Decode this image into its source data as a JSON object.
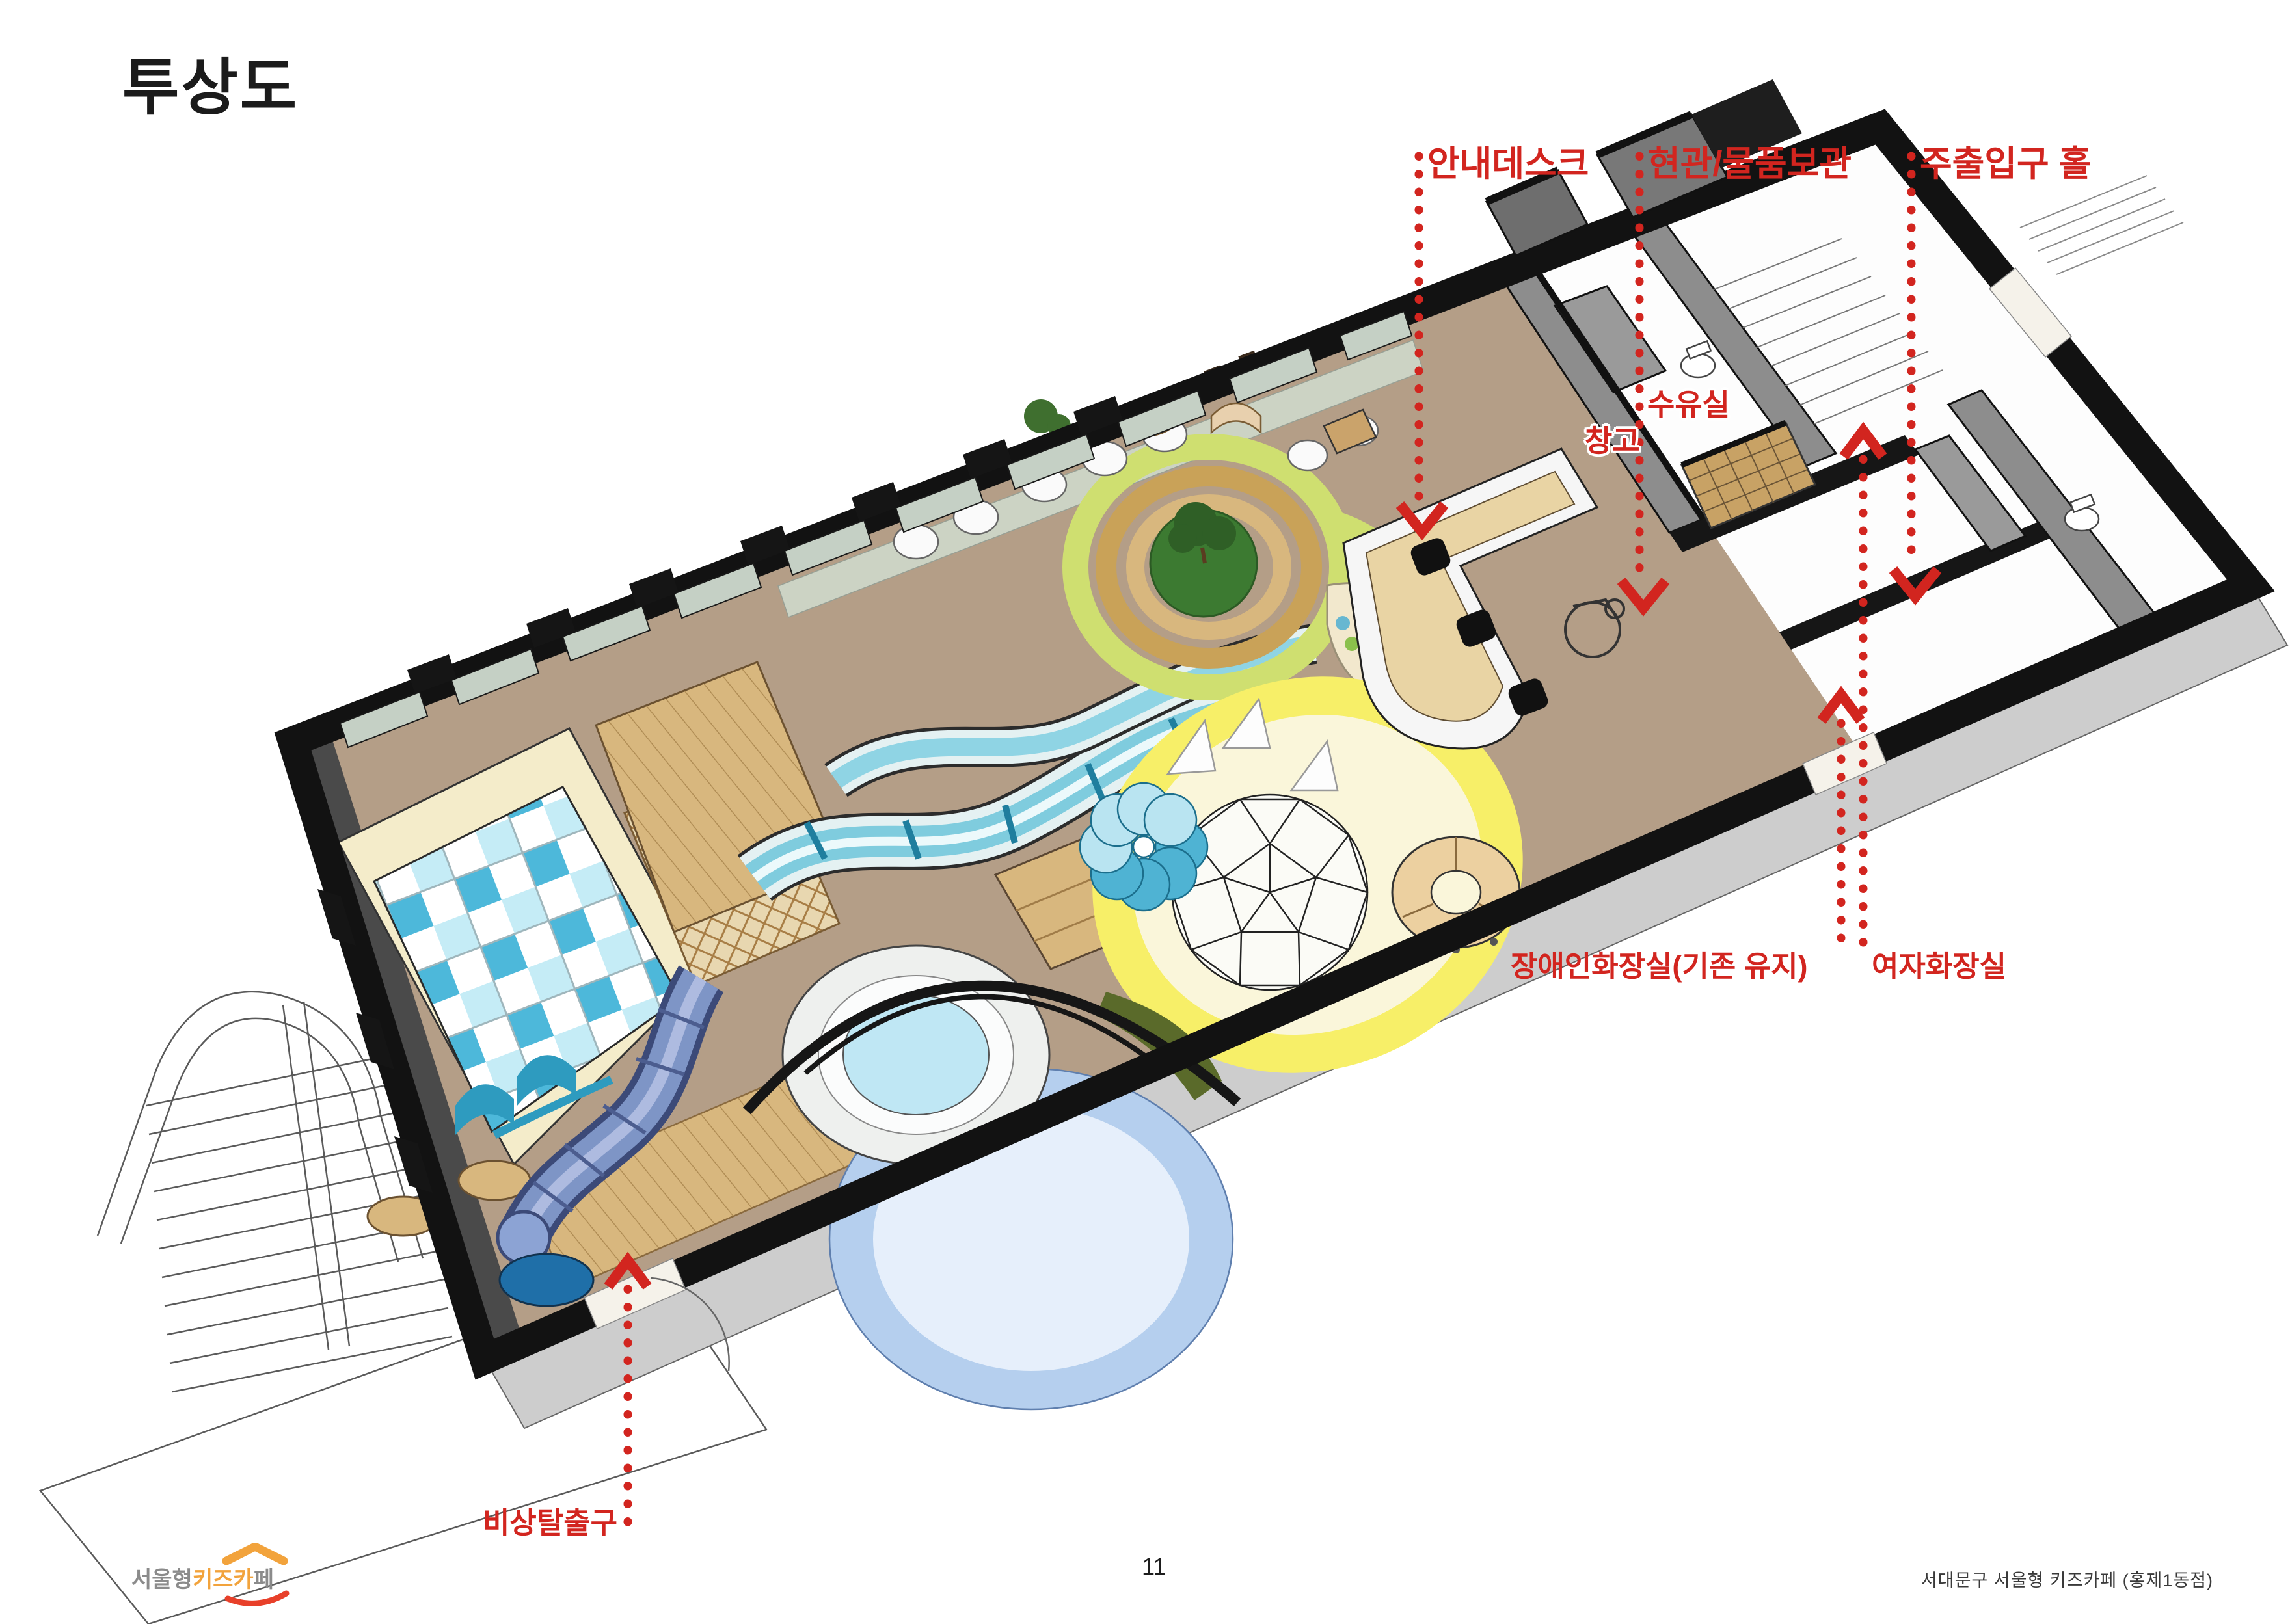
{
  "page": {
    "title": "투상도",
    "page_number": "11",
    "footer_right": "서대문구 서울형 키즈카페 (홍제1동점)"
  },
  "logo": {
    "part1": "서울형",
    "part2": "키즈카",
    "part3": "페"
  },
  "colors": {
    "annotation_red": "#d2251f",
    "logo_orange": "#f2a33c",
    "logo_smile_red": "#e8402a"
  },
  "annotations": [
    {
      "id": "info-desk",
      "label": "안내데스크"
    },
    {
      "id": "entrance-storage",
      "label": "현관/물품보관"
    },
    {
      "id": "main-entrance-hall",
      "label": "주출입구 홀"
    },
    {
      "id": "nursing-room",
      "label": "수유실"
    },
    {
      "id": "storage-room",
      "label": "창고"
    },
    {
      "id": "accessible-restroom",
      "label": "장애인화장실(기존 유지)"
    },
    {
      "id": "womens-restroom",
      "label": "여자화장실"
    },
    {
      "id": "emergency-exit",
      "label": "비상탈출구"
    }
  ]
}
